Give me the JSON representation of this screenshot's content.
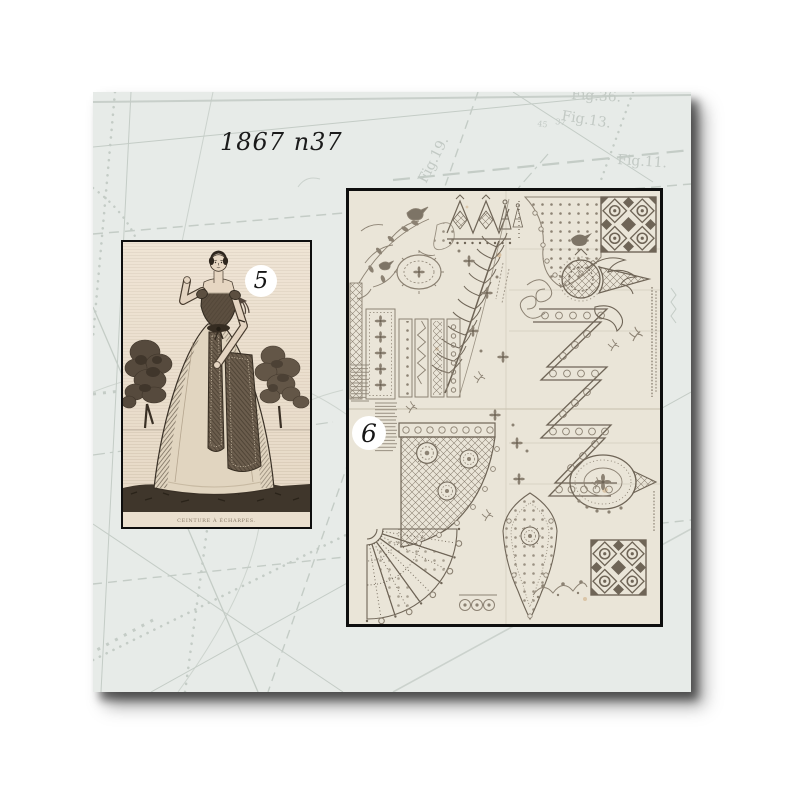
{
  "canvas": {
    "background_color": "#ffffff"
  },
  "page": {
    "title": "1867 n37",
    "paper_color": "#e7ebe8",
    "pattern_line_color": "#c4ccc6",
    "shadow_color": "#1a1a1a",
    "figure_labels": {
      "top": "Fig.36.",
      "fig13": "Fig.13.",
      "fig11": "Fig.11.",
      "fig19": "Fig.19."
    },
    "small_numbers": {
      "left": "45",
      "right": "37"
    }
  },
  "plates": [
    {
      "number": "5",
      "caption": "CEINTURE À ÉCHARPES.",
      "paper_color": "#eadfce",
      "ink_color": "#4a3e31"
    },
    {
      "number": "6",
      "caption": "",
      "paper_color": "#eae5d8",
      "ink_color": "#8c8273"
    }
  ]
}
